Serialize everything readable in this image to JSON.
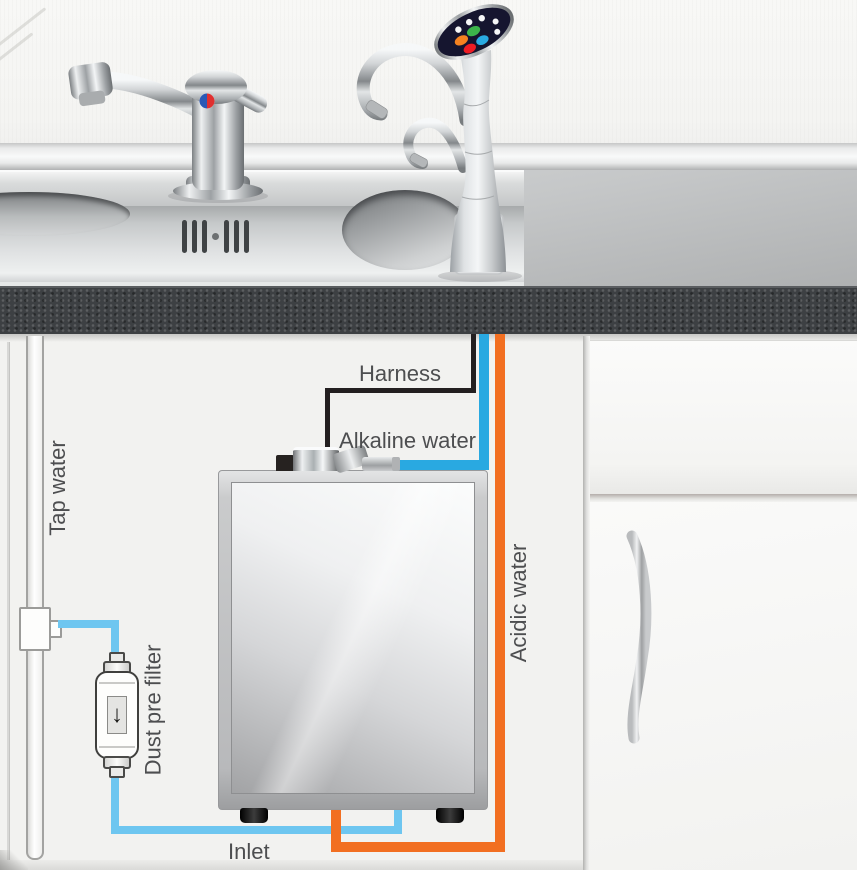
{
  "diagram": {
    "labels": {
      "harness": "Harness",
      "alkaline_water": "Alkaline water",
      "acidic_water": "Acidic water",
      "tap_water": "Tap water",
      "dust_pre_filter": "Dust pre filter",
      "inlet": "Inlet"
    },
    "colors": {
      "harness": "#231f20",
      "alkaline": "#29a9e1",
      "acidic": "#f26f21",
      "inlet": "#6ec6f0",
      "label_text": "#4d4e50",
      "btn_orange": "#f58220",
      "btn_green": "#3cb54a",
      "btn_red": "#ed1c24",
      "btn_blue": "#29aae2"
    },
    "filter_arrow": "↓"
  }
}
